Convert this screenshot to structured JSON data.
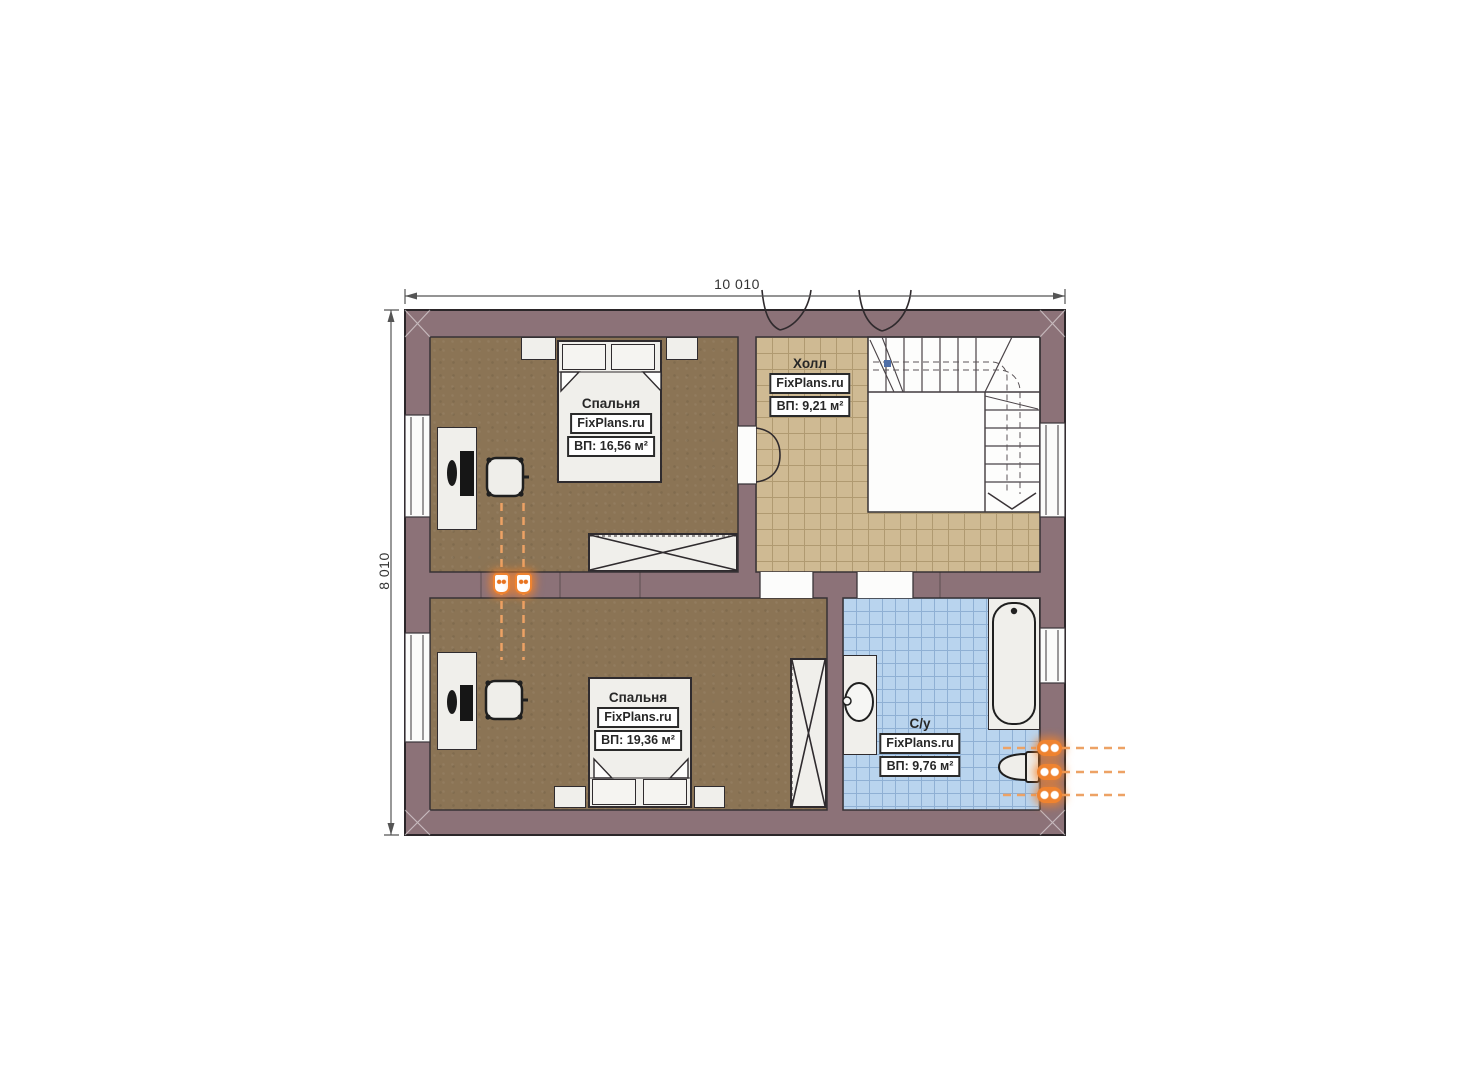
{
  "dimensions": {
    "top": "10 010",
    "left": "8 010"
  },
  "rooms": {
    "bedroom1": {
      "name": "Спальня",
      "brand": "FixPlans.ru",
      "area": "ВП: 16,56 м²"
    },
    "hall": {
      "name": "Холл",
      "brand": "FixPlans.ru",
      "area": "ВП: 9,21 м²"
    },
    "bedroom2": {
      "name": "Спальня",
      "brand": "FixPlans.ru",
      "area": "ВП: 19,36 м²"
    },
    "bathroom": {
      "name": "С/у",
      "brand": "FixPlans.ru",
      "area": "ВП: 9,76 м²"
    }
  },
  "colors": {
    "wall": "#8c7278",
    "wall_outline": "#2b2629",
    "bedroom_floor": "#8b7455",
    "hall_tile": "#cfba93",
    "hall_tile_line": "#b09a71",
    "bath_tile": "#b9d4ee",
    "bath_tile_line": "#8fb0d4",
    "furniture_fill": "#f0efeb",
    "furniture_outline": "#2f2b2e",
    "accent_orange": "#ef8330",
    "dimension_text": "#333333"
  }
}
